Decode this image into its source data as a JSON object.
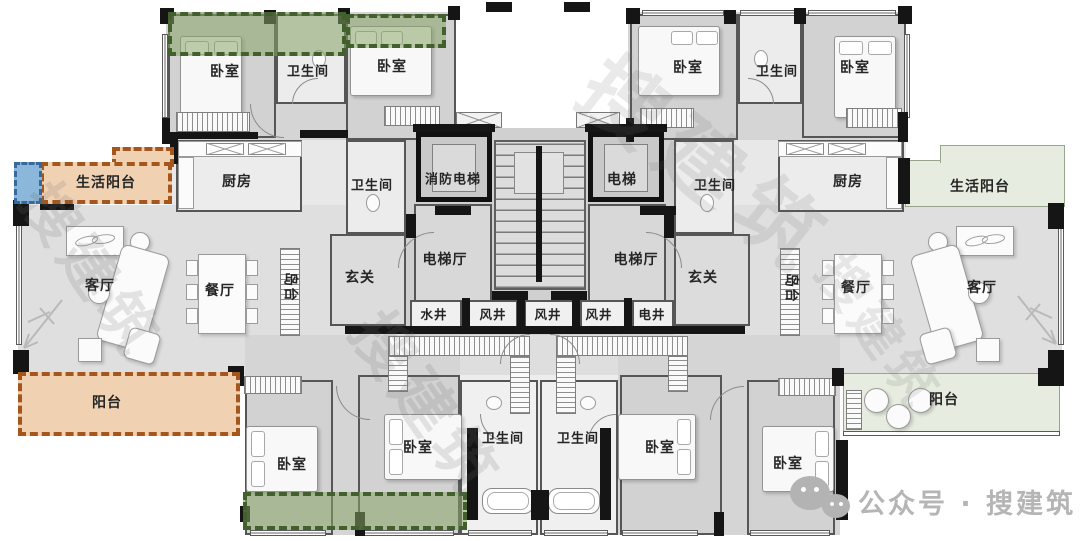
{
  "rooms": [
    {
      "name": "bedroom-top-left",
      "label": "卧室"
    },
    {
      "name": "bathroom-top-left",
      "label": "卫生间"
    },
    {
      "name": "bedroom-top-mid-left",
      "label": "卧室"
    },
    {
      "name": "kitchen-left",
      "label": "厨房"
    },
    {
      "name": "service-balcony-left",
      "label": "生活阳台"
    },
    {
      "name": "bathroom-mid-left",
      "label": "卫生间"
    },
    {
      "name": "foyer-left",
      "label": "玄关"
    },
    {
      "name": "living-room-left",
      "label": "客厅"
    },
    {
      "name": "dining-room-left",
      "label": "餐厅"
    },
    {
      "name": "island-left",
      "label": "岛台"
    },
    {
      "name": "balcony-left",
      "label": "阳台"
    },
    {
      "name": "bedroom-bottom-left",
      "label": "卧室"
    },
    {
      "name": "bedroom-bottom-mid-left",
      "label": "卧室"
    },
    {
      "name": "bathroom-bottom-left",
      "label": "卫生间"
    },
    {
      "name": "fire-elevator",
      "label": "消防电梯"
    },
    {
      "name": "elevator",
      "label": "电梯"
    },
    {
      "name": "elevator-hall-left",
      "label": "电梯厅"
    },
    {
      "name": "elevator-hall-right",
      "label": "电梯厅"
    },
    {
      "name": "shaft-water",
      "label": "水井"
    },
    {
      "name": "shaft-air-1",
      "label": "风井"
    },
    {
      "name": "shaft-air-2",
      "label": "风井"
    },
    {
      "name": "shaft-air-3",
      "label": "风井"
    },
    {
      "name": "shaft-electric",
      "label": "电井"
    },
    {
      "name": "bathroom-bottom-right",
      "label": "卫生间"
    },
    {
      "name": "bedroom-bottom-mid-right",
      "label": "卧室"
    },
    {
      "name": "bedroom-bottom-right",
      "label": "卧室"
    },
    {
      "name": "balcony-right",
      "label": "阳台"
    },
    {
      "name": "foyer-right",
      "label": "玄关"
    },
    {
      "name": "island-right",
      "label": "岛台"
    },
    {
      "name": "dining-room-right",
      "label": "餐厅"
    },
    {
      "name": "living-room-right",
      "label": "客厅"
    },
    {
      "name": "bathroom-mid-right",
      "label": "卫生间"
    },
    {
      "name": "kitchen-right",
      "label": "厨房"
    },
    {
      "name": "service-balcony-right",
      "label": "生活阳台"
    },
    {
      "name": "bedroom-top-mid-right",
      "label": "卧室"
    },
    {
      "name": "bathroom-top-right",
      "label": "卫生间"
    },
    {
      "name": "bedroom-top-right",
      "label": "卧室"
    }
  ],
  "watermark": {
    "brand": "搜建筑",
    "account": "公众号 · 搜建筑"
  },
  "colors": {
    "highlight_green_border": "#42602c",
    "highlight_green_fill": "#8daa6e",
    "highlight_orange_border": "#a4561c",
    "highlight_orange_fill": "#f0d2b3",
    "highlight_blue_border": "#37699f",
    "highlight_blue_fill": "#8ab7da",
    "balcony_pale_green_fill": "#e6ecdf",
    "wall": "#151515",
    "floor_gray": "#d5d5d5"
  }
}
